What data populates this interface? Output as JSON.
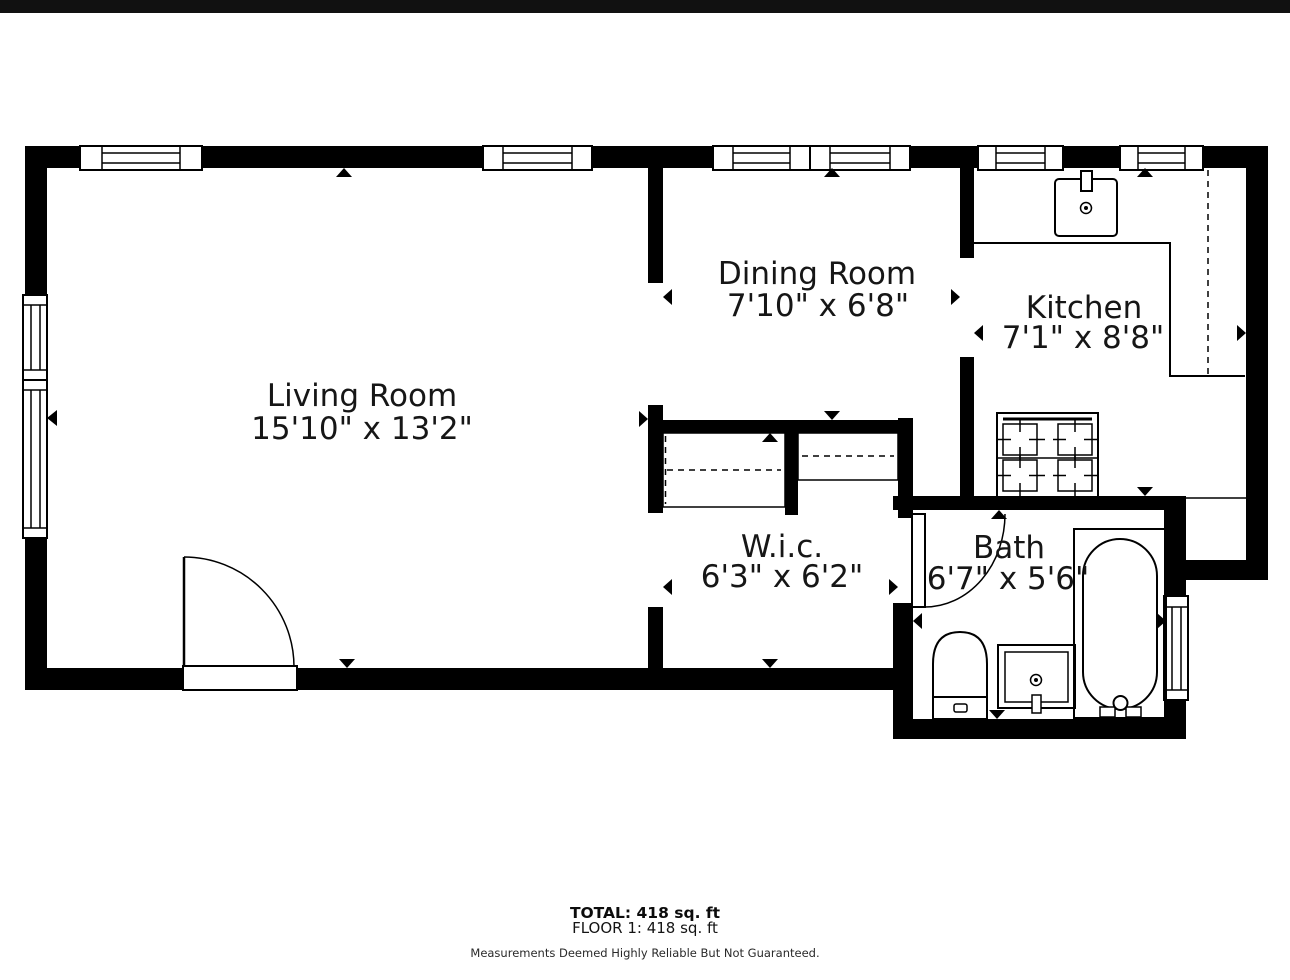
{
  "colors": {
    "wall": "#000000",
    "background": "#ffffff",
    "text": "#161616",
    "top_bar": "#111111"
  },
  "rooms": [
    {
      "name": "Living Room",
      "dimensions": "15'10\" x 13'2\""
    },
    {
      "name": "Dining Room",
      "dimensions": "7'10\" x 6'8\""
    },
    {
      "name": "Kitchen",
      "dimensions": "7'1\" x 8'8\""
    },
    {
      "name": "W.i.c.",
      "dimensions": "6'3\" x 6'2\""
    },
    {
      "name": "Bath",
      "dimensions": "6'7\" x 5'6\""
    }
  ],
  "summary": {
    "total": "TOTAL: 418 sq. ft",
    "floor": "FLOOR 1: 418 sq. ft",
    "disclaimer": "Measurements Deemed Highly Reliable But Not Guaranteed."
  },
  "fixture_icons": {
    "kitchen_sink": "kitchen-sink-icon",
    "stove": "stove-icon",
    "counter": "counter-line",
    "upper_cabinets": "dashed-cabinet-line",
    "toilet": "toilet-icon",
    "bathroom_sink": "bathroom-sink-icon",
    "bathtub": "bathtub-icon",
    "entry_door": "door-swing-icon",
    "bath_door": "door-swing-icon",
    "closet_shelves": "closet-shelf-icon",
    "window": "window-icon",
    "measurement_arrow": "measure-arrow-icon"
  }
}
